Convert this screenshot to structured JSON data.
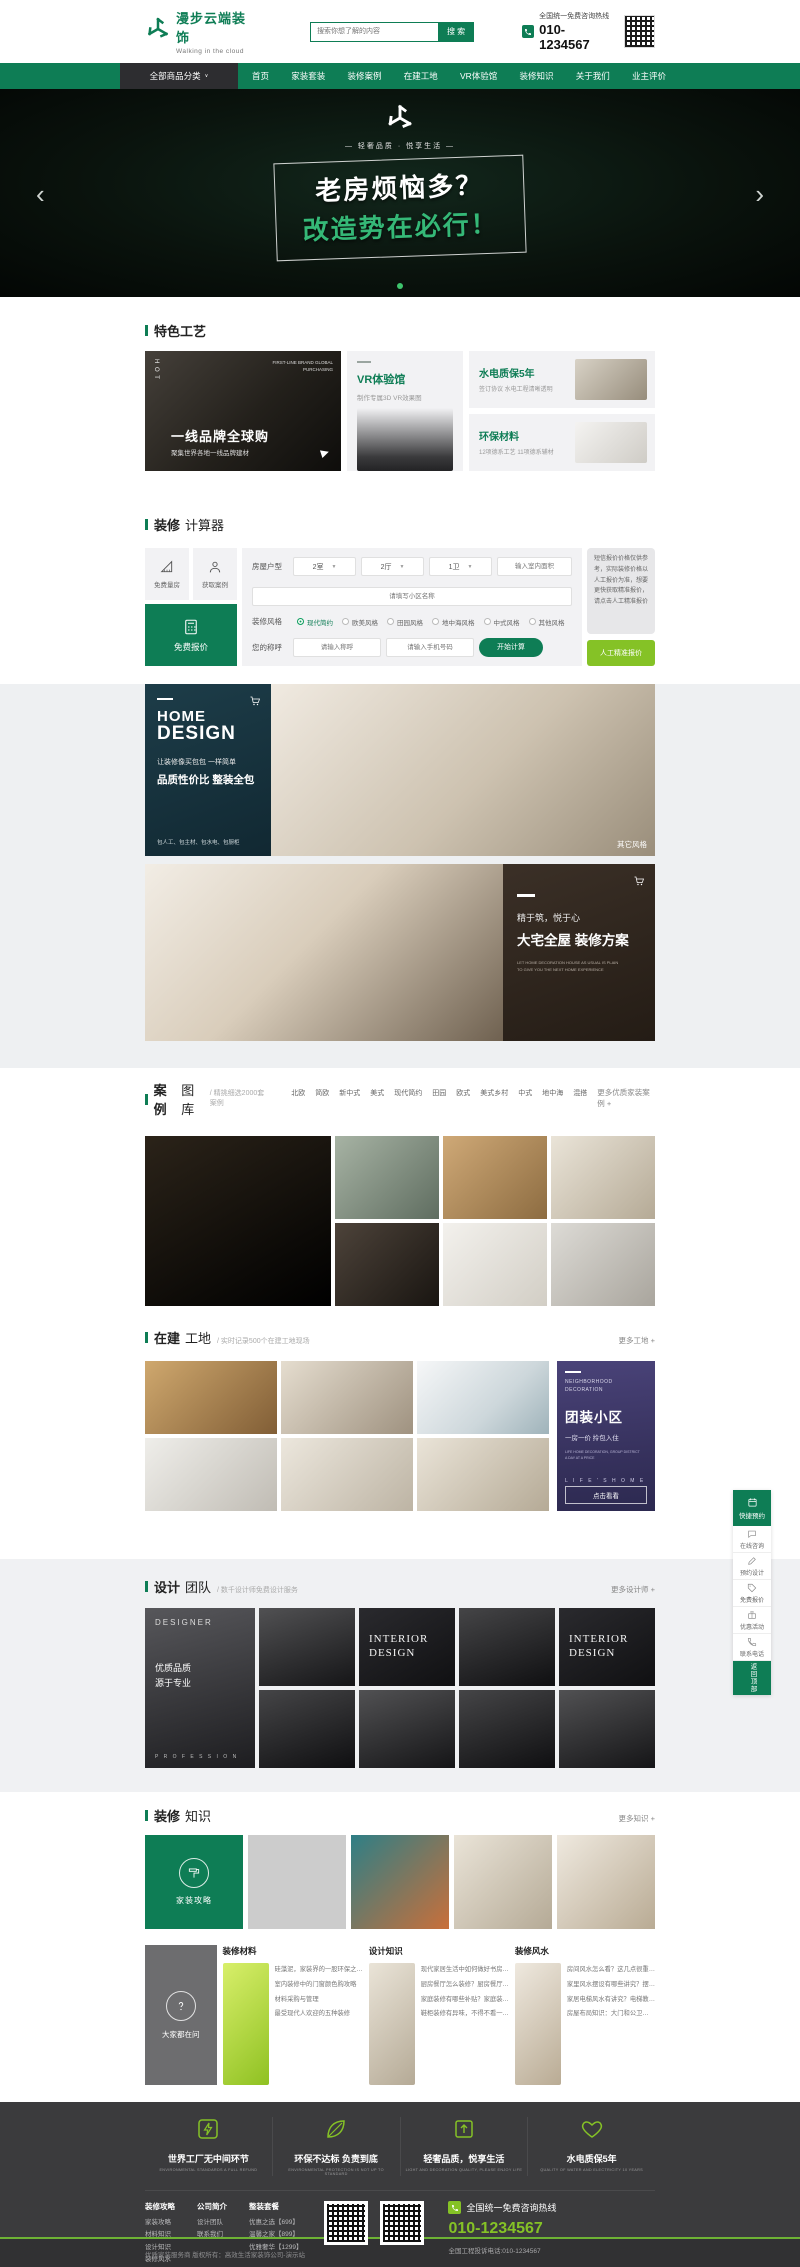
{
  "brand": {
    "name": "漫步云端装饰",
    "tagline": "Walking in the cloud"
  },
  "header": {
    "search_placeholder": "搜索你想了解的内容",
    "search_button": "搜 索",
    "hotline_label": "全国统一免费咨询热线",
    "hotline_number": "010-1234567"
  },
  "nav": {
    "all_categories": "全部商品分类",
    "caret": "∨",
    "items": [
      "首页",
      "家装套装",
      "装修案例",
      "在建工地",
      "VR体验馆",
      "装修知识",
      "关于我们",
      "业主评价"
    ]
  },
  "hero": {
    "slogan": "— 轻奢品质 · 悦享生活 —",
    "line1": "老房烦恼多？",
    "line2": "改造势在必行！",
    "prev": "‹",
    "next": "›"
  },
  "features": {
    "title": "特色工艺",
    "main": {
      "hot": "H O T",
      "eyebrow1": "FIRST-LINE BRAND GLOBAL",
      "eyebrow2": "PURCHASING",
      "title": "一线品牌全球购",
      "subtitle": "聚集世界各地一线品牌建材"
    },
    "vr": {
      "title": "VR体验馆",
      "subtitle": "制作专属3D VR效果图"
    },
    "card1": {
      "title": "水电质保5年",
      "subtitle": "签订协议 水电工程清晰透明"
    },
    "card2": {
      "title": "环保材料",
      "subtitle": "12项德系工艺 11项德系辅材"
    }
  },
  "calculator": {
    "title_strong": "装修",
    "title_light": "计算器",
    "shortcut1": "免费量房",
    "shortcut2": "获取案例",
    "quote": "免费报价",
    "house_label": "房屋户型",
    "rooms": "2室",
    "halls": "2厅",
    "baths": "1卫",
    "caret": "▼",
    "area_placeholder": "输入室内面积",
    "community_placeholder": "请填写小区名称",
    "style_label": "装修风格",
    "styles": [
      "现代简约",
      "欧美风格",
      "田园风格",
      "地中海风格",
      "中式风格",
      "其他风格"
    ],
    "name_label": "您的称呼",
    "name_placeholder": "请输入称呼",
    "phone_placeholder": "请输入手机号码",
    "submit": "开始计算",
    "notice": "短信报价价格仅供参考，实际装修价格以人工报价为准，想要更快获取精准报价，请点击人工精准报价",
    "manual": "人工精准报价"
  },
  "banner_home": {
    "t1": "HOME",
    "t2": "DESIGN",
    "l1": "让装修像买包包 一样简单",
    "l2": "品质性价比  整装全包",
    "l3": "包人工、包主材、包水电、包厨柜",
    "corner": "其它风格"
  },
  "banner_mansion": {
    "l1": "精于筑，悦于心",
    "l2": "大宅全屋 装修方案",
    "l3": "LET HOME DECORATION HOUSE AS USUAL IS PLAIN",
    "l4": "TO GIVE YOU THE NEXT HOME EXPERIENCE"
  },
  "cases": {
    "title_strong": "案例",
    "title_light": "图库",
    "subtitle": "/ 精挑细选2000套案例",
    "tabs": [
      "北欧",
      "简欧",
      "新中式",
      "美式",
      "现代简约",
      "田园",
      "欧式",
      "美式乡村",
      "中式",
      "地中海",
      "混搭"
    ],
    "more": "更多优质家装案例 +"
  },
  "sites": {
    "title_strong": "在建",
    "title_light": "工地",
    "subtitle": "/ 实时记录500个在建工地现场",
    "more": "更多工地 +",
    "promo": {
      "eyebrow1": "NEIGHBORHOOD",
      "eyebrow2": "DECORATION",
      "title": "团装小区",
      "subtitle": "一房一价 拎包入住",
      "cap1": "LIFE HOME DECORATION, GROUP DISTRICT",
      "cap2": "A DAY AT A PRICE",
      "life": "L I F E ' S   H O M E",
      "button": "点击看看"
    }
  },
  "team": {
    "title_strong": "设计",
    "title_light": "团队",
    "subtitle": "/ 数千设计师免费设计服务",
    "more": "更多设计师 +",
    "designer": "DESIGNER",
    "q1": "优质品质",
    "q2": "源于专业",
    "profession": "P R O F E S S I O N",
    "tile1": "INTERIOR",
    "tile2": "DESIGN"
  },
  "knowledge": {
    "title_strong": "装修",
    "title_light": "知识",
    "more": "更多知识 +",
    "strategy": "家装攻略",
    "ask": "大家都在问",
    "col1": {
      "title": "装修材料",
      "items": [
        "硅藻泥，家装界的一股环保之…",
        "室内装修中的门窗颜色购攻略",
        "材料采购与管理",
        "最受现代人欢迎的五种装修"
      ]
    },
    "col2": {
      "title": "设计知识",
      "items": [
        "现代家居生活中如何做好书房…",
        "厨房餐厅怎么装修？厨房餐厅…",
        "家庭装修有哪些补贴？家庭装…",
        "鞋柜装修有异味，不得不看一…"
      ]
    },
    "col3": {
      "title": "装修风水",
      "items": [
        "房间风水怎么看？这几点很重…",
        "家里风水摆设有哪些讲究？摆…",
        "家居电梯风水有讲究？电梯教…",
        "房屋布局知识：大门和公卫…"
      ]
    }
  },
  "footer": {
    "features": [
      {
        "title": "世界工厂无中间环节",
        "en": "ENVIRONMENTAL STANDARDS A FULL REFUND"
      },
      {
        "title": "环保不达标 负责到底",
        "en": "ENVIRONMENTAL PROTECTION IS NOT UP TO STANDARD"
      },
      {
        "title": "轻奢品质，悦享生活",
        "en": "LIGHT AND DECORATION QUALITY, PLEASE ENJOY LIFE"
      },
      {
        "title": "水电质保5年",
        "en": "QUALITY OF WATER AND ELECTRICITY 10 YEARS"
      }
    ],
    "groups": [
      {
        "title": "装修攻略",
        "links": [
          "家装攻略",
          "材料知识",
          "设计知识",
          "装修风水"
        ]
      },
      {
        "title": "公司简介",
        "links": [
          "设计团队",
          "联系我们"
        ]
      },
      {
        "title": "整装套餐",
        "links": [
          "优惠之选【699】",
          "温馨之家【899】",
          "优雅奢华【1299】"
        ]
      }
    ],
    "hotline_label": "全国统一免费咨询热线",
    "hotline_number": "010-1234567",
    "complaint": "全国工程投诉电话:010-1234567",
    "copyright": "优质家装服务商 版权所有：高效生活家装饰公司-演示站"
  },
  "floating": {
    "header": "快捷预约",
    "items": [
      "在线咨询",
      "预约设计",
      "免费报价",
      "优惠活动",
      "联系电话"
    ],
    "back": "返回顶部"
  }
}
